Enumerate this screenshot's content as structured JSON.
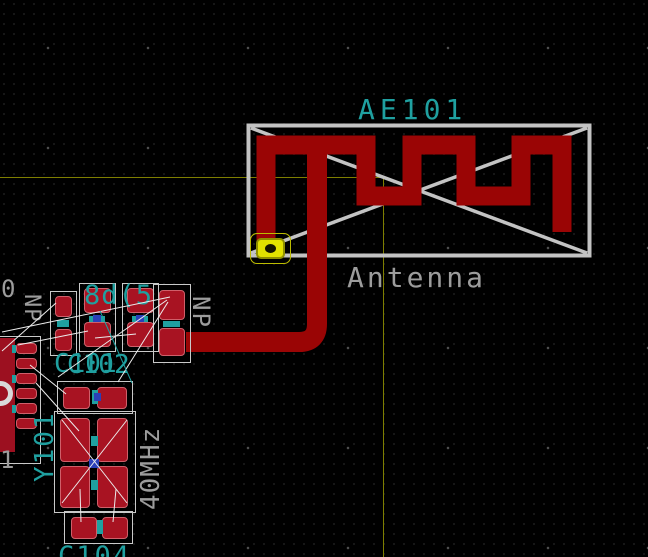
{
  "window": {
    "app_kind": "pcb-layout-editor-canvas",
    "bg_color": "#000000"
  },
  "grid": {
    "minor_px": 10,
    "major_px": 100
  },
  "cursor": {
    "x": 383,
    "y": 177,
    "color": "#7e7e00"
  },
  "antenna_footprint": {
    "reference": "AE101",
    "value": "Antenna",
    "reference_color": "#1fa0a0",
    "value_color": "#9c9c9c",
    "outline": {
      "rect": [
        248.5,
        125.5,
        341,
        130
      ],
      "diagonals": [
        [
          251,
          128,
          587,
          253
        ],
        [
          251,
          253,
          587,
          128
        ]
      ],
      "stroke": "#c3c3c3",
      "rect_width": 4,
      "diag_width": 3.5
    },
    "feed_pad": {
      "highlighted": true,
      "fill": "#e2e200",
      "x": 256,
      "y": 238,
      "w": 29,
      "h": 21
    }
  },
  "copper": {
    "color": "#9a0505",
    "meander_points": "266,253 266,145 366,145 366,196 412,196 412,145 466,145 466,196 521,196 521,145 562,145 562,232",
    "meander_width": 19,
    "feed_path": "M 317 150 L 317 324 Q 317 342 299 342 L 186 342",
    "feed_width": 20
  },
  "ratsnest": {
    "color": "#ececec",
    "segments": [
      [
        2,
        332,
        170,
        297
      ],
      [
        2,
        351,
        56,
        303
      ],
      [
        18,
        345,
        88,
        331
      ],
      [
        58,
        377,
        167,
        300
      ],
      [
        168,
        302,
        118,
        382
      ],
      [
        36,
        383,
        79,
        431
      ],
      [
        62,
        420,
        127,
        503
      ],
      [
        62,
        503,
        127,
        420
      ],
      [
        80,
        489,
        81,
        522
      ],
      [
        116,
        489,
        113,
        522
      ],
      [
        30,
        365,
        66,
        394
      ],
      [
        95,
        338,
        136,
        334
      ]
    ],
    "aux_color": "#1fa0a0",
    "aux_segments": [
      [
        100,
        311,
        132,
        383
      ]
    ]
  },
  "labels": {
    "ae101": "AE101",
    "antenna": "Antenna",
    "np_right": "NP",
    "np_left": "NP",
    "overlap_refs_top": "8d(5",
    "c101": "C101",
    "c102": "C102",
    "y101": "Y101",
    "freq": "40MHz",
    "c104": "C104",
    "edge_zero": "0",
    "edge_one": "1"
  }
}
